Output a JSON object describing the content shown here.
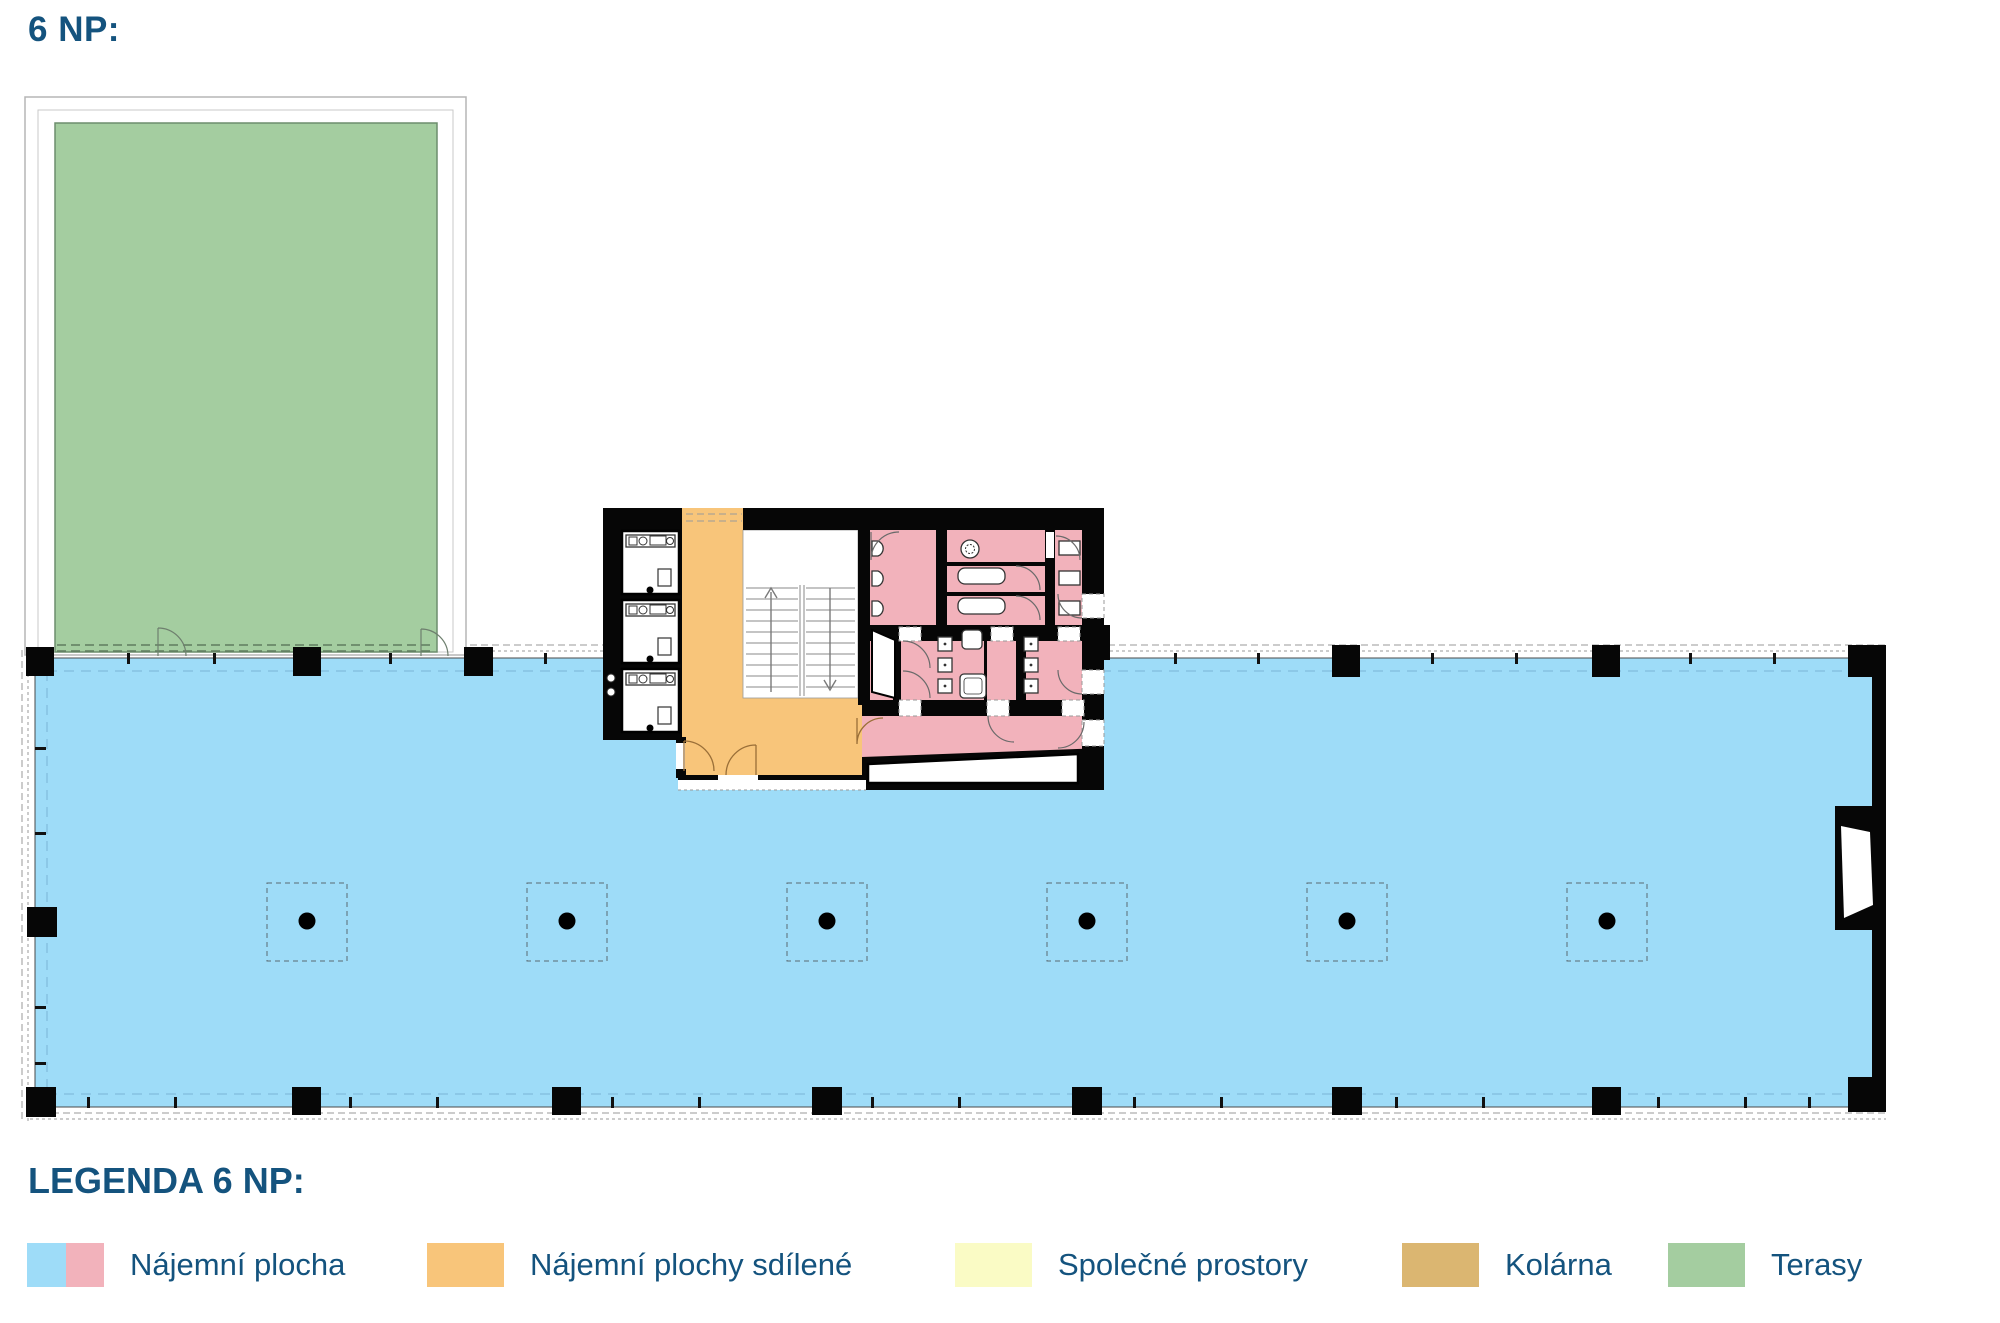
{
  "title": "6 NP:",
  "legend": {
    "title": "LEGENDA 6 NP:",
    "items": [
      {
        "label": "Nájemní plocha",
        "swatch": [
          "blue",
          "pink"
        ]
      },
      {
        "label": "Nájemní plochy sdílené",
        "swatch": [
          "orange"
        ]
      },
      {
        "label": "Společné prostory",
        "swatch": [
          "yellow"
        ]
      },
      {
        "label": "Kolárna",
        "swatch": [
          "tan"
        ]
      },
      {
        "label": "Terasy",
        "swatch": [
          "green"
        ]
      }
    ]
  },
  "colors": {
    "text": "#14537e",
    "blue": "#9edcf8",
    "pink": "#f2b2bb",
    "orange": "#f8c57a",
    "yellow": "#fafbc5",
    "tan": "#dbb671",
    "green": "#a4cda0",
    "wall": "#060606",
    "dash": "#9a9a9a"
  }
}
